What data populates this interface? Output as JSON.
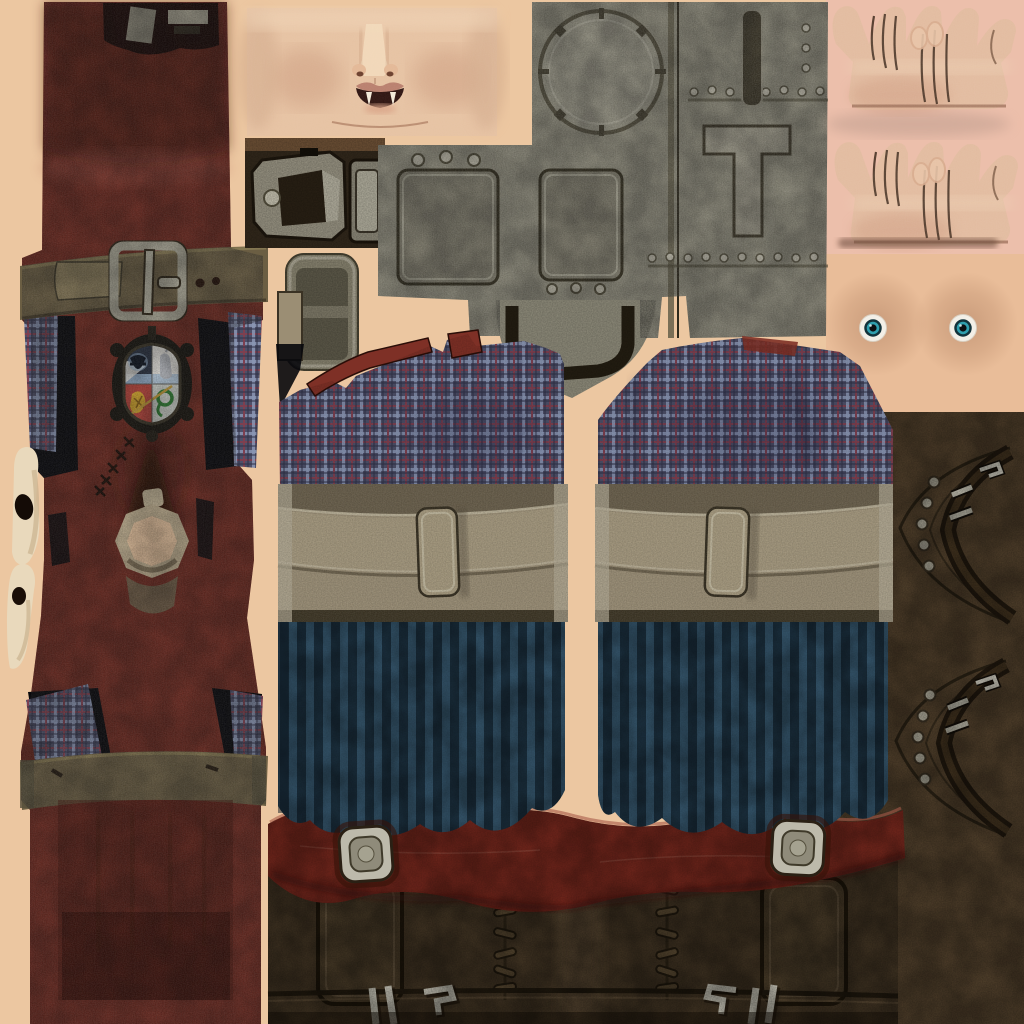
{
  "meta": {
    "type": "game-texture-atlas",
    "subject": "Character outfit and skin UV texture sheet (hero clothing set)",
    "canvas_size": "1024x1024",
    "visible_text": "none"
  },
  "palette": {
    "background": "#ecc7a1",
    "background_pink": "#ecbfab",
    "torso_skin": "#e9bd99",
    "face_skin": "#e6c2a2",
    "hand_skin": "#e2bb9f",
    "ear_skin": "#e9d9bc",
    "red_leather": "#6e291f",
    "red_leather_light": "#a4564a",
    "red_leather_dark": "#40140d",
    "red_belt": "#7c2a1f",
    "red_trim": "#7e3026",
    "olive_belt": "#6b5e43",
    "olive_belt_light": "#8a7c5a",
    "bone_ring": "#c2b191",
    "plate_stone": "#8f8c7b",
    "metal_light": "#bdbaab",
    "metal_mid": "#9a9584",
    "metal_dark": "#3c3626",
    "canister_metal": "#8b8672",
    "plaid_base": "#4e5069",
    "plaid_blue": "#8b96b4",
    "plaid_red": "#7d4050",
    "straw_khaki": "#9b8e74",
    "stripe_light": "#3a5d75",
    "stripe_dark": "#1e3444",
    "boot_brown": "#463826",
    "strap_panel": "#57452f",
    "eye_white": "#f2efe7",
    "eye_iris": "#2f9fae",
    "eye_pupil": "#0b0f12",
    "crest_navy": "#2a3242",
    "crest_silver": "#e8e6e0",
    "crest_red": "#b8433a",
    "crest_green": "#2e7d32",
    "crest_gold": "#d8a92c",
    "crest_blue": "#9db9d6",
    "black_shadow": "#08080c"
  },
  "pieces": {
    "robe_front": {
      "label": "red leather robe front panel",
      "features": [
        "top notch",
        "waist belt",
        "guild crest",
        "neck ring hole",
        "stitch scar",
        "lower belt band"
      ]
    },
    "waist_belt": {
      "label": "olive leather belt with metal buckle",
      "hole_count": 2
    },
    "guild_crest": {
      "label": "four-quarter heraldic crest",
      "quadrants": [
        "dark bird on navy",
        "hare on silver",
        "gold lion on red",
        "green serpent on silver"
      ],
      "extras": [
        "gold sword diagonal",
        "ornate dark frame"
      ]
    },
    "neck_ring": {
      "label": "bone collar ring with open hole"
    },
    "face_skin": {
      "label": "lower face skin with nose and open fanged mouth",
      "fang_count": 2
    },
    "buckle_hardware": {
      "label": "metal buckle frame and clasp plate on dark leather patch"
    },
    "canister": {
      "label": "two-segment metal canister pouch"
    },
    "chest_plate": {
      "label": "riveted armor plate",
      "features": [
        "notched circular port",
        "two recessed panels",
        "T-shaped brace",
        "rivet rows",
        "shield-point bottom with dark horseshoe band"
      ]
    },
    "hands": {
      "label": "two hand skin textures with finger creases",
      "count": 2
    },
    "torso_eyes": {
      "label": "torso skin patch with two eyes",
      "eye_count": 2
    },
    "shirt_left": {
      "label": "plaid shirt panel with red trim and khaki waistband",
      "strap": "center buckle strap"
    },
    "shirt_right": {
      "label": "plaid shirt panel (back) with khaki waistband",
      "strap": "center buckle strap"
    },
    "trousers": {
      "label": "two striped trouser fabric panels",
      "count": 2
    },
    "boot_belt": {
      "label": "red leather boot belt",
      "buckle_count": 2
    },
    "boot_uppers": {
      "label": "boot uppers with flaps, lace stitching and silver hooks",
      "stitch_columns": 2,
      "hook_sets": 2
    },
    "boot_straps": {
      "label": "studded chevron boot straps on brown leather",
      "stud_rows": 2,
      "buckles": 2
    },
    "ear_skin": {
      "label": "ear/skin fragments on left edge",
      "count": 2
    }
  }
}
